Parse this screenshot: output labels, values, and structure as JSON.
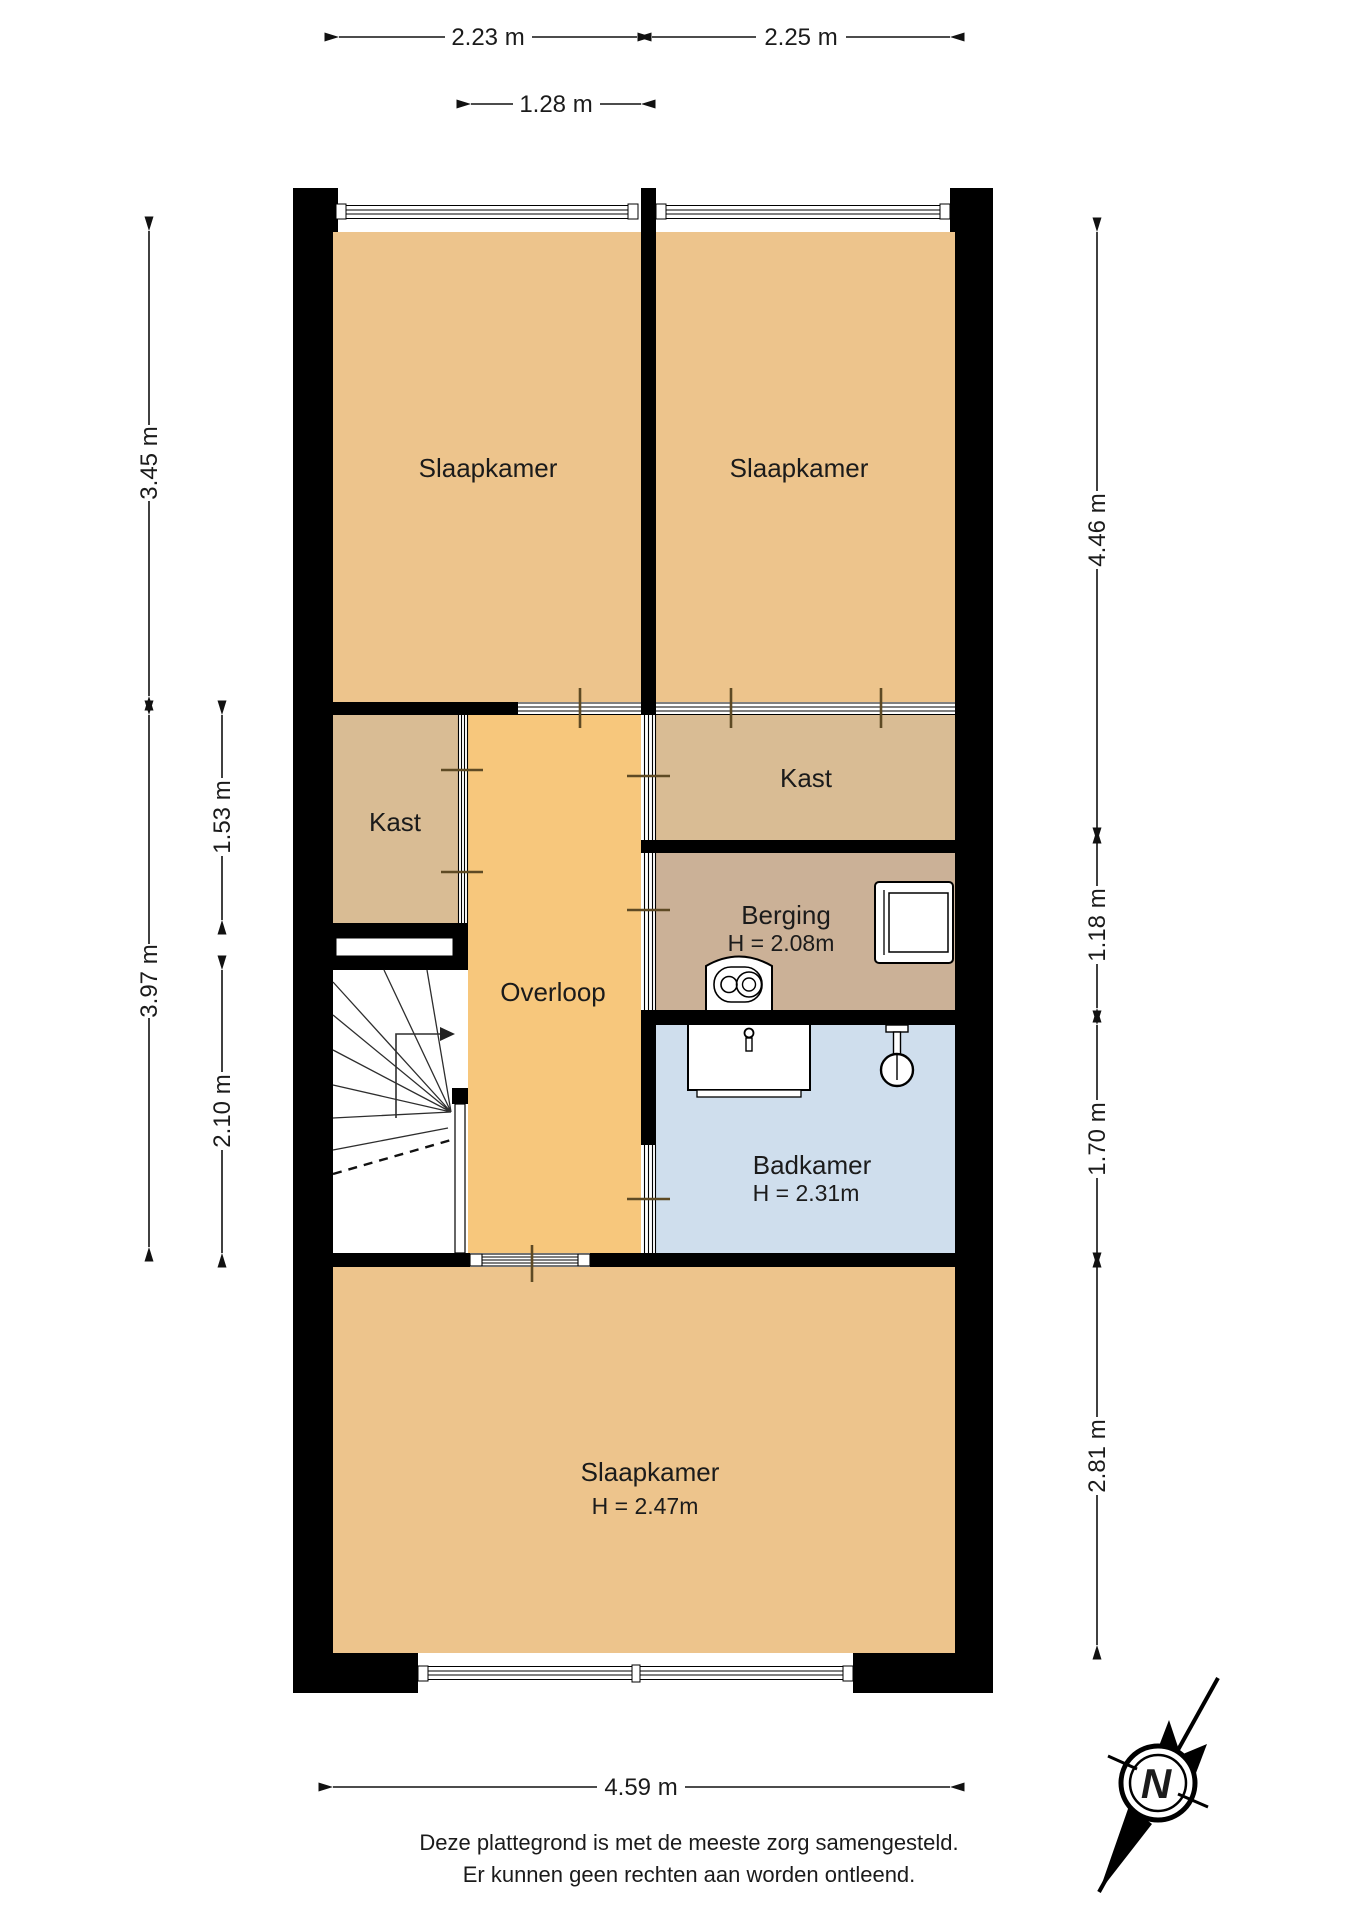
{
  "rooms": {
    "slaapkamer_1": {
      "label": "Slaapkamer"
    },
    "slaapkamer_2": {
      "label": "Slaapkamer"
    },
    "kast_links": {
      "label": "Kast"
    },
    "kast_rechts": {
      "label": "Kast"
    },
    "overloop": {
      "label": "Overloop"
    },
    "berging": {
      "label": "Berging",
      "height": "H = 2.08m"
    },
    "badkamer": {
      "label": "Badkamer",
      "height": "H = 2.31m"
    },
    "slaapkamer_3": {
      "label": "Slaapkamer",
      "height": "H = 2.47m"
    }
  },
  "dimensions": {
    "top_left": "2.23 m",
    "top_right": "2.25 m",
    "top_overloop": "1.28 m",
    "left_outer_top": "3.45 m",
    "left_outer_bottom": "3.97 m",
    "left_inner_top": "1.53 m",
    "left_inner_bottom": "2.10 m",
    "right_top": "4.46 m",
    "right_berging": "1.18 m",
    "right_badkamer": "1.70 m",
    "right_bottom": "2.81 m",
    "bottom": "4.59 m"
  },
  "compass": {
    "north_label": "N"
  },
  "footer": {
    "line1": "Deze plattegrond is met de meeste zorg samengesteld.",
    "line2": "Er kunnen geen rechten aan worden ontleend."
  },
  "colors": {
    "wall": "#000000",
    "bedroom_fill": "#edc48c",
    "hallway_fill": "#f7c77c",
    "closet_fill": "#d9bc94",
    "storage_fill": "#cbb197",
    "bathroom_fill": "#cfdeed",
    "door_tick": "#5e4a24",
    "background": "#ffffff"
  }
}
